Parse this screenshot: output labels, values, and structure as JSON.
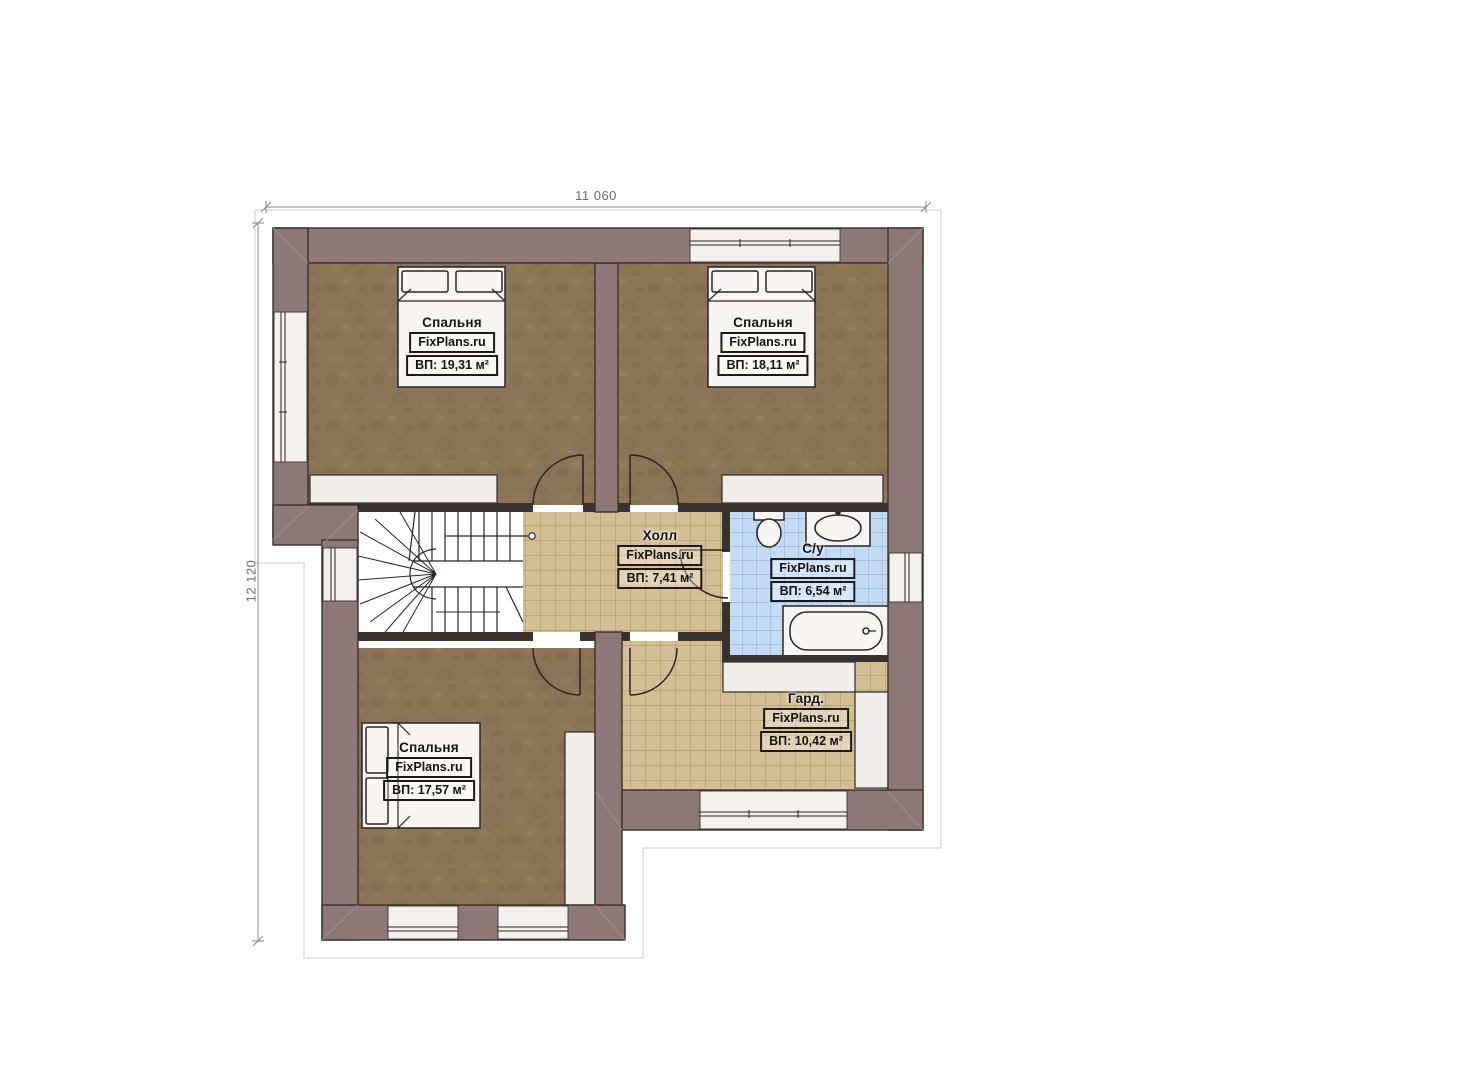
{
  "dimensions": {
    "width_label": "11 060",
    "height_label": "12 120"
  },
  "rooms": [
    {
      "id": "bedroom-top-left",
      "name": "Спальня",
      "watermark": "FixPlans.ru",
      "area": "ВП: 19,31 м²"
    },
    {
      "id": "bedroom-top-right",
      "name": "Спальня",
      "watermark": "FixPlans.ru",
      "area": "ВП: 18,11 м²"
    },
    {
      "id": "hall",
      "name": "Холл",
      "watermark": "FixPlans.ru",
      "area": "ВП: 7,41 м²"
    },
    {
      "id": "bathroom",
      "name": "С/у",
      "watermark": "FixPlans.ru",
      "area": "ВП: 6,54 м²"
    },
    {
      "id": "wardrobe",
      "name": "Гард.",
      "watermark": "FixPlans.ru",
      "area": "ВП: 10,42 м²"
    },
    {
      "id": "bedroom-bottom-left",
      "name": "Спальня",
      "watermark": "FixPlans.ru",
      "area": "ВП: 17,57 м²"
    }
  ],
  "colors": {
    "wall": "#8b7877",
    "wall_outline": "#3b3130",
    "carpet": "#8c7556",
    "tile_beige": "#d4be93",
    "tile_beige_line": "#a38d66",
    "tile_blue": "#c3dbf3",
    "tile_blue_line": "#7ea6d2",
    "fixture_white": "#f6f5f3",
    "dimension_gray": "#8a8786"
  }
}
